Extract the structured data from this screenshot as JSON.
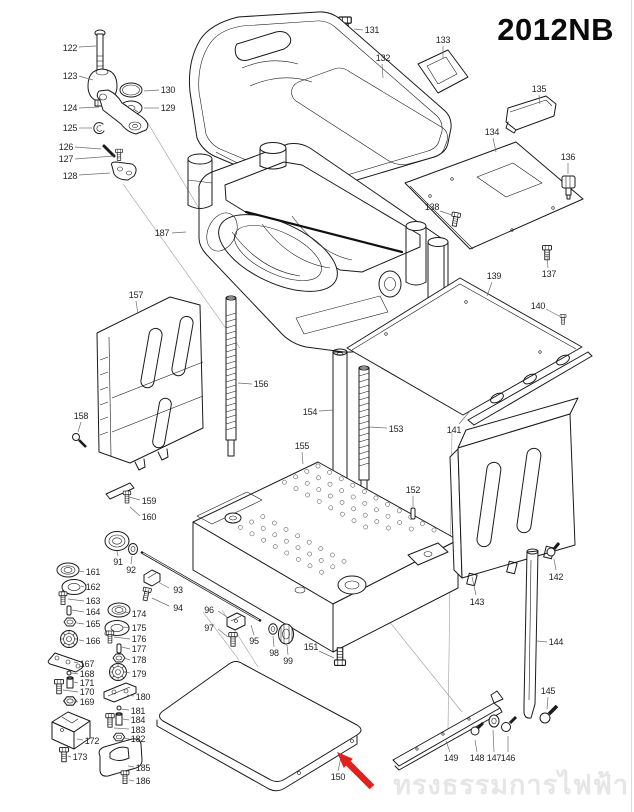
{
  "title": "2012NB",
  "watermark": "ทรงธรรมการไฟฟ้า",
  "diagram": {
    "type": "exploded-parts-diagram",
    "highlight": {
      "part": "150",
      "arrow_color": "#e3201b"
    },
    "labels": [
      {
        "n": "122",
        "x": 70,
        "y": 48,
        "l": [
          79,
          47,
          96,
          46
        ]
      },
      {
        "n": "123",
        "x": 70,
        "y": 76,
        "l": [
          79,
          76,
          93,
          80
        ]
      },
      {
        "n": "130",
        "x": 168,
        "y": 90,
        "l": [
          159,
          90,
          144,
          91
        ]
      },
      {
        "n": "129",
        "x": 168,
        "y": 108,
        "l": [
          159,
          108,
          144,
          108
        ]
      },
      {
        "n": "124",
        "x": 70,
        "y": 108,
        "l": [
          79,
          108,
          99,
          107
        ]
      },
      {
        "n": "125",
        "x": 70,
        "y": 128,
        "l": [
          79,
          128,
          92,
          128
        ]
      },
      {
        "n": "126",
        "x": 66,
        "y": 147,
        "l": [
          75,
          147,
          101,
          149
        ]
      },
      {
        "n": "127",
        "x": 66,
        "y": 159,
        "l": [
          75,
          159,
          114,
          156
        ]
      },
      {
        "n": "128",
        "x": 70,
        "y": 176,
        "l": [
          79,
          175,
          110,
          173
        ]
      },
      {
        "n": "131",
        "x": 372,
        "y": 30,
        "l": [
          363,
          30,
          354,
          29
        ]
      },
      {
        "n": "132",
        "x": 383,
        "y": 58,
        "l": [
          382,
          64,
          383,
          78
        ]
      },
      {
        "n": "133",
        "x": 443,
        "y": 40,
        "l": [
          443,
          46,
          443,
          58
        ]
      },
      {
        "n": "135",
        "x": 539,
        "y": 89,
        "l": [
          539,
          95,
          540,
          104
        ]
      },
      {
        "n": "134",
        "x": 492,
        "y": 132,
        "l": [
          493,
          138,
          496,
          152
        ]
      },
      {
        "n": "136",
        "x": 568,
        "y": 157,
        "l": [
          568,
          163,
          568,
          174
        ]
      },
      {
        "n": "138",
        "x": 432,
        "y": 207,
        "l": [
          440,
          211,
          452,
          215
        ]
      },
      {
        "n": "137",
        "x": 549,
        "y": 274,
        "l": [
          548,
          268,
          547,
          255
        ]
      },
      {
        "n": "139",
        "x": 494,
        "y": 276,
        "l": [
          492,
          282,
          487,
          296
        ]
      },
      {
        "n": "140",
        "x": 538,
        "y": 306,
        "l": [
          546,
          309,
          559,
          316
        ]
      },
      {
        "n": "187",
        "x": 162,
        "y": 233,
        "l": [
          172,
          233,
          186,
          232
        ]
      },
      {
        "n": "157",
        "x": 136,
        "y": 295,
        "l": [
          136,
          301,
          138,
          314
        ]
      },
      {
        "n": "158",
        "x": 81,
        "y": 416,
        "l": [
          81,
          422,
          78,
          432
        ]
      },
      {
        "n": "156",
        "x": 261,
        "y": 384,
        "l": [
          252,
          384,
          238,
          383
        ]
      },
      {
        "n": "154",
        "x": 310,
        "y": 412,
        "l": [
          319,
          411,
          333,
          410
        ]
      },
      {
        "n": "153",
        "x": 396,
        "y": 429,
        "l": [
          387,
          428,
          369,
          427
        ]
      },
      {
        "n": "155",
        "x": 302,
        "y": 446,
        "l": [
          302,
          452,
          303,
          464
        ]
      },
      {
        "n": "141",
        "x": 454,
        "y": 430,
        "l": [
          459,
          424,
          470,
          411
        ]
      },
      {
        "n": "152",
        "x": 413,
        "y": 490,
        "l": [
          413,
          496,
          413,
          507
        ]
      },
      {
        "n": "159",
        "x": 149,
        "y": 501,
        "l": [
          140,
          500,
          129,
          497
        ]
      },
      {
        "n": "160",
        "x": 149,
        "y": 517,
        "l": [
          140,
          516,
          130,
          507
        ]
      },
      {
        "n": "91",
        "x": 118,
        "y": 562,
        "l": [
          118,
          556,
          117,
          551
        ]
      },
      {
        "n": "92",
        "x": 131,
        "y": 570,
        "l": [
          131,
          564,
          132,
          556
        ]
      },
      {
        "n": "93",
        "x": 178,
        "y": 590,
        "l": [
          169,
          588,
          158,
          582
        ]
      },
      {
        "n": "94",
        "x": 178,
        "y": 608,
        "l": [
          169,
          606,
          152,
          598
        ]
      },
      {
        "n": "161",
        "x": 93,
        "y": 572,
        "l": [
          84,
          572,
          79,
          571
        ]
      },
      {
        "n": "162",
        "x": 93,
        "y": 587,
        "l": [
          84,
          587,
          81,
          586
        ]
      },
      {
        "n": "163",
        "x": 93,
        "y": 601,
        "l": [
          84,
          601,
          68,
          599
        ]
      },
      {
        "n": "164",
        "x": 93,
        "y": 612,
        "l": [
          84,
          612,
          72,
          610
        ]
      },
      {
        "n": "165",
        "x": 93,
        "y": 624,
        "l": [
          84,
          624,
          77,
          623
        ]
      },
      {
        "n": "166",
        "x": 93,
        "y": 641,
        "l": [
          84,
          641,
          79,
          640
        ]
      },
      {
        "n": "174",
        "x": 139,
        "y": 614,
        "l": [
          130,
          613,
          123,
          612
        ]
      },
      {
        "n": "175",
        "x": 139,
        "y": 628,
        "l": [
          130,
          628,
          123,
          627
        ]
      },
      {
        "n": "176",
        "x": 139,
        "y": 639,
        "l": [
          130,
          639,
          114,
          637
        ]
      },
      {
        "n": "177",
        "x": 139,
        "y": 649,
        "l": [
          130,
          649,
          122,
          647
        ]
      },
      {
        "n": "178",
        "x": 139,
        "y": 660,
        "l": [
          130,
          660,
          124,
          658
        ]
      },
      {
        "n": "179",
        "x": 139,
        "y": 674,
        "l": [
          130,
          673,
          124,
          672
        ]
      },
      {
        "n": "167",
        "x": 87,
        "y": 664,
        "l": [
          78,
          663,
          74,
          662
        ]
      },
      {
        "n": "168",
        "x": 87,
        "y": 674,
        "l": [
          78,
          674,
          72,
          673
        ]
      },
      {
        "n": "171",
        "x": 87,
        "y": 683,
        "l": [
          78,
          683,
          74,
          682
        ]
      },
      {
        "n": "170",
        "x": 87,
        "y": 692,
        "l": [
          78,
          692,
          63,
          690
        ]
      },
      {
        "n": "169",
        "x": 87,
        "y": 702,
        "l": [
          78,
          702,
          74,
          701
        ]
      },
      {
        "n": "172",
        "x": 92,
        "y": 741,
        "l": [
          83,
          740,
          77,
          739
        ]
      },
      {
        "n": "173",
        "x": 80,
        "y": 757,
        "l": [
          71,
          757,
          68,
          756
        ]
      },
      {
        "n": "180",
        "x": 143,
        "y": 697,
        "l": [
          134,
          696,
          127,
          695
        ]
      },
      {
        "n": "181",
        "x": 138,
        "y": 711,
        "l": [
          129,
          710,
          121,
          709
        ]
      },
      {
        "n": "184",
        "x": 138,
        "y": 720,
        "l": [
          129,
          720,
          123,
          719
        ]
      },
      {
        "n": "183",
        "x": 138,
        "y": 730,
        "l": [
          129,
          729,
          114,
          728
        ]
      },
      {
        "n": "182",
        "x": 138,
        "y": 739,
        "l": [
          129,
          739,
          124,
          738
        ]
      },
      {
        "n": "185",
        "x": 143,
        "y": 768,
        "l": [
          134,
          767,
          128,
          766
        ]
      },
      {
        "n": "186",
        "x": 143,
        "y": 781,
        "l": [
          134,
          781,
          129,
          780
        ]
      },
      {
        "n": "95",
        "x": 254,
        "y": 641,
        "l": [
          254,
          635,
          251,
          625
        ]
      },
      {
        "n": "96",
        "x": 209,
        "y": 610,
        "l": [
          218,
          611,
          227,
          617
        ]
      },
      {
        "n": "97",
        "x": 209,
        "y": 628,
        "l": [
          218,
          629,
          228,
          637
        ]
      },
      {
        "n": "98",
        "x": 274,
        "y": 653,
        "l": [
          274,
          647,
          273,
          636
        ]
      },
      {
        "n": "99",
        "x": 288,
        "y": 661,
        "l": [
          288,
          655,
          287,
          645
        ]
      },
      {
        "n": "151",
        "x": 311,
        "y": 647,
        "l": [
          319,
          651,
          334,
          658
        ]
      },
      {
        "n": "150",
        "x": 338,
        "y": 777,
        "l": [
          338,
          771,
          341,
          757
        ]
      },
      {
        "n": "149",
        "x": 451,
        "y": 758,
        "l": [
          450,
          752,
          446,
          741
        ]
      },
      {
        "n": "148",
        "x": 477,
        "y": 758,
        "l": [
          477,
          752,
          475,
          740
        ]
      },
      {
        "n": "147",
        "x": 494,
        "y": 758,
        "l": [
          494,
          752,
          493,
          730
        ]
      },
      {
        "n": "146",
        "x": 508,
        "y": 758,
        "l": [
          508,
          752,
          508,
          736
        ]
      },
      {
        "n": "145",
        "x": 548,
        "y": 691,
        "l": [
          548,
          697,
          547,
          709
        ]
      },
      {
        "n": "144",
        "x": 556,
        "y": 642,
        "l": [
          547,
          642,
          537,
          641
        ]
      },
      {
        "n": "142",
        "x": 556,
        "y": 577,
        "l": [
          556,
          570,
          554,
          559
        ]
      },
      {
        "n": "143",
        "x": 477,
        "y": 602,
        "l": [
          476,
          595,
          472,
          577
        ]
      }
    ]
  }
}
